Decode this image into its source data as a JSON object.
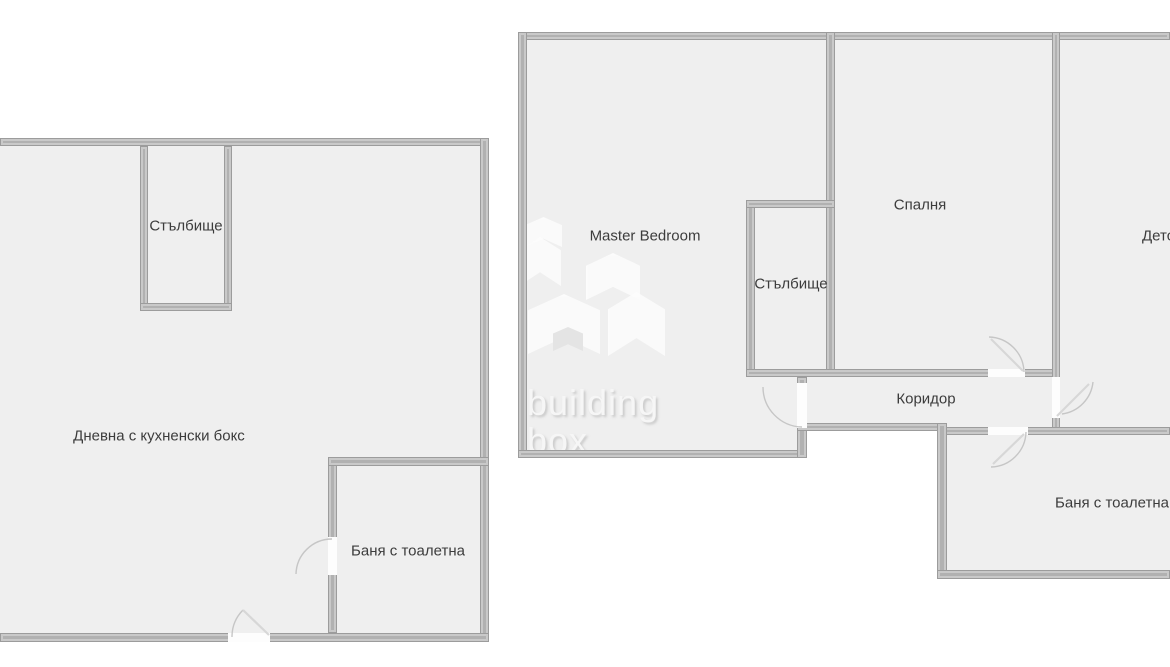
{
  "canvas": {
    "width": 1170,
    "height": 667
  },
  "colors": {
    "background": "#ffffff",
    "floor": "#efefef",
    "wall": "#b1b1b1",
    "wall_edge_dark": "#9c9c9c",
    "wall_edge_light": "#c9c9c9",
    "door_arc": "#c6c6c6",
    "label_text": "#3c3c3c",
    "watermark": "#f6f6f6"
  },
  "plans": {
    "left": {
      "labels": {
        "staircase": "Стълбище",
        "living": "Дневна с кухненски бокс",
        "bathroom": "Баня с тоалетна"
      }
    },
    "right": {
      "labels": {
        "master_bedroom": "Master Bedroom",
        "staircase": "Стълбище",
        "bedroom": "Спалня",
        "corridor": "Коридор",
        "kids_room": "Детска",
        "bathroom": "Баня с тоалетна"
      }
    }
  },
  "watermark": {
    "line1": "building",
    "line2": "box"
  }
}
